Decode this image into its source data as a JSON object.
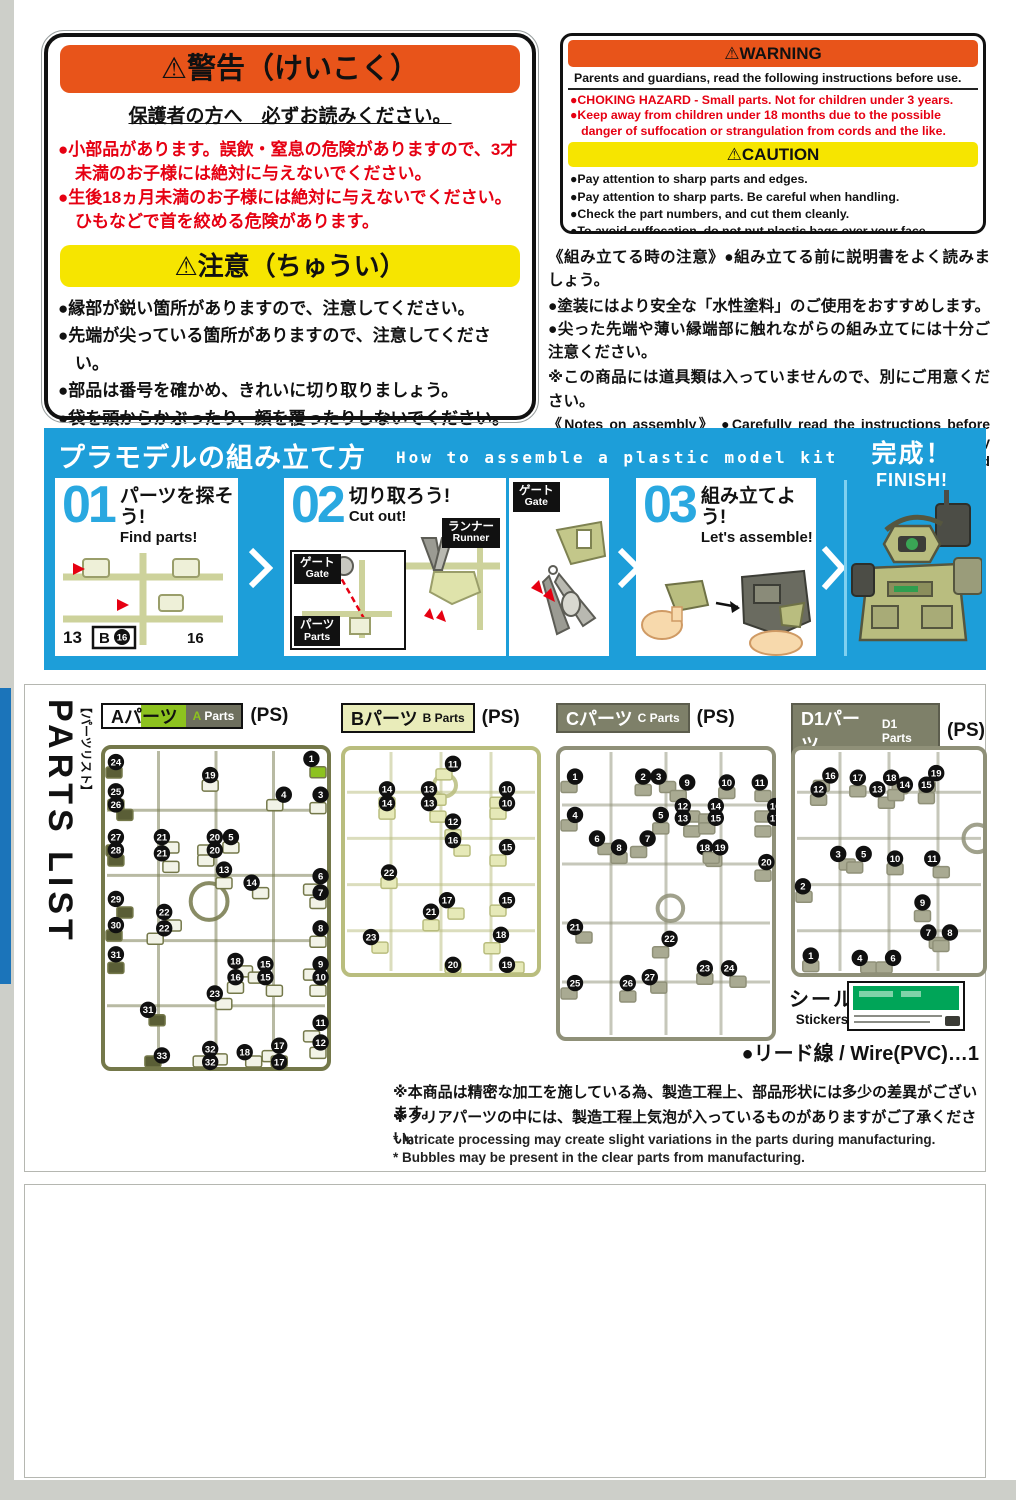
{
  "jp_warning": {
    "title": "⚠警告（けいこく）",
    "subtitle": "保護者の方へ　必ずお読みください。",
    "warning_items": [
      "●小部品があります。誤飲・窒息の危険がありますので、3才未満のお子様には絶対に与えないでください。",
      "●生後18ヵ月未満のお子様には絶対に与えないでください。ひもなどで首を絞める危険があります。"
    ],
    "caution_title": "⚠注意（ちゅうい）",
    "caution_items": [
      "●縁部が鋭い箇所がありますので、注意してください。",
      "●先端が尖っている箇所がありますので、注意してください。",
      "●部品は番号を確かめ、きれいに切り取りましょう。",
      "●袋を頭からかぶったり、顔を覆ったりしないでください。窒息する恐れがあります。"
    ]
  },
  "en_warning": {
    "title": "⚠WARNING",
    "intro": "Parents and guardians, read the following instructions before use.",
    "warning_items": [
      "●CHOKING HAZARD - Small parts. Not for children under 3 years.",
      "●Keep away from children under 18 months due to the possible danger of suffocation or strangulation from cords and the like."
    ],
    "caution_title": "⚠CAUTION",
    "caution_items": [
      "●Pay attention to sharp parts and edges.",
      "●Pay attention to sharp parts. Be careful when handling.",
      "●Check the part numbers, and cut them cleanly.",
      "●To avoid suffocation, do not put plastic bags over your face."
    ]
  },
  "notes": {
    "jp1": "《組み立てる時の注意》●組み立てる前に説明書をよく読みましょう。",
    "jp2": "●塗装にはより安全な「水性塗料」のご使用をおすすめします。●尖った先端や薄い縁端部に触れながらの組み立てには十分ご注意ください。",
    "jp3": "※この商品には道具類は入っていませんので、別にご用意ください。",
    "en": "《Notes on assembly》 ●Carefully read the instructions before assembling. ●Use of water-based paint is recommended for safety reasons. ●Pay extra attention when handling sharp points and edges. * Tools are not included."
  },
  "how_to": {
    "title_jp": "プラモデルの組み立て方",
    "title_en": "How to assemble a plastic model kit",
    "finish_jp": "完成！",
    "finish_en": "FINISH!",
    "steps": [
      {
        "num": "01",
        "jp": "パーツを探そう!",
        "en": "Find parts!"
      },
      {
        "num": "02",
        "jp": "切り取ろう!",
        "en": "Cut out!"
      },
      {
        "num": "03",
        "jp": "組み立てよう!",
        "en": "Let's assemble!"
      }
    ],
    "labels": {
      "runner_jp": "ランナー",
      "runner_en": "Runner",
      "gate_jp": "ゲート",
      "gate_en": "Gate",
      "parts_jp": "パーツ",
      "parts_en": "Parts"
    },
    "step1_marks": {
      "left": "13",
      "boxed_letter": "B",
      "boxed_num": "16",
      "right": "16"
    }
  },
  "parts_list": {
    "title": "PARTS LIST",
    "title_jp": "【パーツリスト】",
    "material": "(PS)",
    "stickers_jp": "シール",
    "stickers_en": "Stickers",
    "wire_note": "●リード線 / Wire(PVC)…1",
    "footnotes_jp": [
      "※本商品は精密な加工を施している為、製造工程上、部品形状には多少の差異がございます。",
      "※クリアパーツの中には、製造工程上気泡が入っているものがありますがご了承ください。"
    ],
    "footnotes_en": [
      "* Intricate processing may create slight variations in the parts during manufacturing.",
      "* Bubbles may be present in the clear parts from manufacturing."
    ],
    "runners": [
      {
        "id": "A",
        "label_jp": "Aパーツ",
        "label_en": "A Parts",
        "x": 76,
        "y": 60,
        "w": 230,
        "h": 326,
        "frame": "#74784a",
        "part": "#f2f3e7",
        "dark": "#5a5e36",
        "accent": "#8dc21f",
        "ring": {
          "x": 47,
          "y": 48,
          "r": 8
        },
        "callouts": [
          {
            "n": 24,
            "x": 3,
            "y": 4,
            "d": 1
          },
          {
            "n": 25,
            "x": 3,
            "y": 13,
            "d": 1
          },
          {
            "n": 26,
            "x": 3,
            "y": 17,
            "d": 1
          },
          {
            "n": 27,
            "x": 3,
            "y": 27,
            "d": 1
          },
          {
            "n": 28,
            "x": 3,
            "y": 31,
            "d": 1
          },
          {
            "n": 29,
            "x": 3,
            "y": 46,
            "d": 1
          },
          {
            "n": 30,
            "x": 3,
            "y": 54,
            "d": 1
          },
          {
            "n": 31,
            "x": 3,
            "y": 63,
            "d": 1
          },
          {
            "n": 31,
            "x": 17,
            "y": 80,
            "d": 1
          },
          {
            "n": 33,
            "x": 23,
            "y": 94,
            "d": 1
          },
          {
            "n": 19,
            "x": 44,
            "y": 8
          },
          {
            "n": 1,
            "x": 88,
            "y": 3,
            "a": 1
          },
          {
            "n": 4,
            "x": 76,
            "y": 14
          },
          {
            "n": 3,
            "x": 92,
            "y": 14
          },
          {
            "n": 21,
            "x": 23,
            "y": 27
          },
          {
            "n": 20,
            "x": 46,
            "y": 27
          },
          {
            "n": 5,
            "x": 53,
            "y": 27
          },
          {
            "n": 21,
            "x": 23,
            "y": 32
          },
          {
            "n": 20,
            "x": 46,
            "y": 31
          },
          {
            "n": 13,
            "x": 50,
            "y": 37
          },
          {
            "n": 14,
            "x": 62,
            "y": 41
          },
          {
            "n": 6,
            "x": 92,
            "y": 39
          },
          {
            "n": 7,
            "x": 92,
            "y": 44
          },
          {
            "n": 22,
            "x": 24,
            "y": 50
          },
          {
            "n": 22,
            "x": 24,
            "y": 55
          },
          {
            "n": 8,
            "x": 92,
            "y": 55
          },
          {
            "n": 18,
            "x": 55,
            "y": 65
          },
          {
            "n": 15,
            "x": 68,
            "y": 66
          },
          {
            "n": 16,
            "x": 55,
            "y": 70
          },
          {
            "n": 15,
            "x": 68,
            "y": 70
          },
          {
            "n": 9,
            "x": 92,
            "y": 66
          },
          {
            "n": 10,
            "x": 92,
            "y": 70
          },
          {
            "n": 23,
            "x": 46,
            "y": 75
          },
          {
            "n": 11,
            "x": 92,
            "y": 84
          },
          {
            "n": 12,
            "x": 92,
            "y": 90
          },
          {
            "n": 18,
            "x": 59,
            "y": 93
          },
          {
            "n": 17,
            "x": 74,
            "y": 91
          },
          {
            "n": 17,
            "x": 74,
            "y": 96
          },
          {
            "n": 32,
            "x": 44,
            "y": 92
          },
          {
            "n": 32,
            "x": 44,
            "y": 96
          }
        ]
      },
      {
        "id": "B",
        "label_jp": "Bパーツ",
        "label_en": "B Parts",
        "x": 316,
        "y": 61,
        "w": 200,
        "h": 231,
        "frame": "#b9bd7e",
        "part": "#e6e9b8",
        "dark": "#cdd194",
        "accent": "#e6e9b8",
        "ring": {
          "x": 52,
          "y": 17,
          "r": 5.5
        },
        "callouts": [
          {
            "n": 11,
            "x": 52,
            "y": 6
          },
          {
            "n": 14,
            "x": 19,
            "y": 17
          },
          {
            "n": 13,
            "x": 40,
            "y": 17
          },
          {
            "n": 10,
            "x": 79,
            "y": 17
          },
          {
            "n": 14,
            "x": 19,
            "y": 23
          },
          {
            "n": 13,
            "x": 40,
            "y": 23
          },
          {
            "n": 10,
            "x": 79,
            "y": 23
          },
          {
            "n": 12,
            "x": 52,
            "y": 31
          },
          {
            "n": 16,
            "x": 52,
            "y": 39
          },
          {
            "n": 15,
            "x": 79,
            "y": 42
          },
          {
            "n": 22,
            "x": 20,
            "y": 53
          },
          {
            "n": 17,
            "x": 49,
            "y": 65
          },
          {
            "n": 15,
            "x": 79,
            "y": 65
          },
          {
            "n": 21,
            "x": 41,
            "y": 70
          },
          {
            "n": 23,
            "x": 11,
            "y": 81
          },
          {
            "n": 18,
            "x": 76,
            "y": 80
          },
          {
            "n": 20,
            "x": 52,
            "y": 93
          },
          {
            "n": 19,
            "x": 79,
            "y": 93
          }
        ]
      },
      {
        "id": "C",
        "label_jp": "Cパーツ",
        "label_en": "C Parts",
        "x": 531,
        "y": 61,
        "w": 220,
        "h": 295,
        "frame": "#8f9078",
        "part": "#a9aa92",
        "dark": "#8a8b72",
        "accent": "#a9aa92",
        "ring": {
          "x": 52,
          "y": 55,
          "r": 5.8
        },
        "callouts": [
          {
            "n": 1,
            "x": 5,
            "y": 9
          },
          {
            "n": 2,
            "x": 36,
            "y": 9
          },
          {
            "n": 3,
            "x": 43,
            "y": 9
          },
          {
            "n": 9,
            "x": 56,
            "y": 11
          },
          {
            "n": 10,
            "x": 74,
            "y": 11
          },
          {
            "n": 11,
            "x": 89,
            "y": 11
          },
          {
            "n": 4,
            "x": 5,
            "y": 22
          },
          {
            "n": 5,
            "x": 44,
            "y": 22
          },
          {
            "n": 12,
            "x": 54,
            "y": 19
          },
          {
            "n": 14,
            "x": 69,
            "y": 19
          },
          {
            "n": 16,
            "x": 96,
            "y": 19
          },
          {
            "n": 13,
            "x": 54,
            "y": 23
          },
          {
            "n": 15,
            "x": 69,
            "y": 23
          },
          {
            "n": 17,
            "x": 96,
            "y": 23
          },
          {
            "n": 6,
            "x": 15,
            "y": 30
          },
          {
            "n": 7,
            "x": 38,
            "y": 30
          },
          {
            "n": 8,
            "x": 25,
            "y": 33
          },
          {
            "n": 18,
            "x": 64,
            "y": 33
          },
          {
            "n": 19,
            "x": 71,
            "y": 33
          },
          {
            "n": 20,
            "x": 92,
            "y": 38
          },
          {
            "n": 21,
            "x": 5,
            "y": 60
          },
          {
            "n": 22,
            "x": 48,
            "y": 64
          },
          {
            "n": 23,
            "x": 64,
            "y": 74
          },
          {
            "n": 24,
            "x": 75,
            "y": 74
          },
          {
            "n": 25,
            "x": 5,
            "y": 79
          },
          {
            "n": 26,
            "x": 29,
            "y": 79
          },
          {
            "n": 27,
            "x": 39,
            "y": 77
          }
        ]
      },
      {
        "id": "D1",
        "label_jp": "D1パーツ",
        "label_en": "D1 Parts",
        "x": 766,
        "y": 61,
        "w": 196,
        "h": 231,
        "frame": "#8f9078",
        "part": "#a9aa92",
        "dark": "#8a8b72",
        "accent": "#a9aa92",
        "ring": {
          "x": 95,
          "y": 40,
          "r": 7
        },
        "callouts": [
          {
            "n": 16,
            "x": 16,
            "y": 11
          },
          {
            "n": 17,
            "x": 30,
            "y": 12
          },
          {
            "n": 18,
            "x": 47,
            "y": 12
          },
          {
            "n": 19,
            "x": 70,
            "y": 10
          },
          {
            "n": 12,
            "x": 10,
            "y": 17
          },
          {
            "n": 13,
            "x": 40,
            "y": 17
          },
          {
            "n": 14,
            "x": 54,
            "y": 15
          },
          {
            "n": 15,
            "x": 65,
            "y": 15
          },
          {
            "n": 3,
            "x": 20,
            "y": 45
          },
          {
            "n": 5,
            "x": 33,
            "y": 45
          },
          {
            "n": 10,
            "x": 49,
            "y": 47
          },
          {
            "n": 11,
            "x": 68,
            "y": 47
          },
          {
            "n": 2,
            "x": 2,
            "y": 59
          },
          {
            "n": 9,
            "x": 63,
            "y": 66
          },
          {
            "n": 7,
            "x": 66,
            "y": 79
          },
          {
            "n": 8,
            "x": 77,
            "y": 79
          },
          {
            "n": 1,
            "x": 6,
            "y": 89
          },
          {
            "n": 4,
            "x": 31,
            "y": 90
          },
          {
            "n": 6,
            "x": 48,
            "y": 90
          }
        ]
      }
    ]
  }
}
